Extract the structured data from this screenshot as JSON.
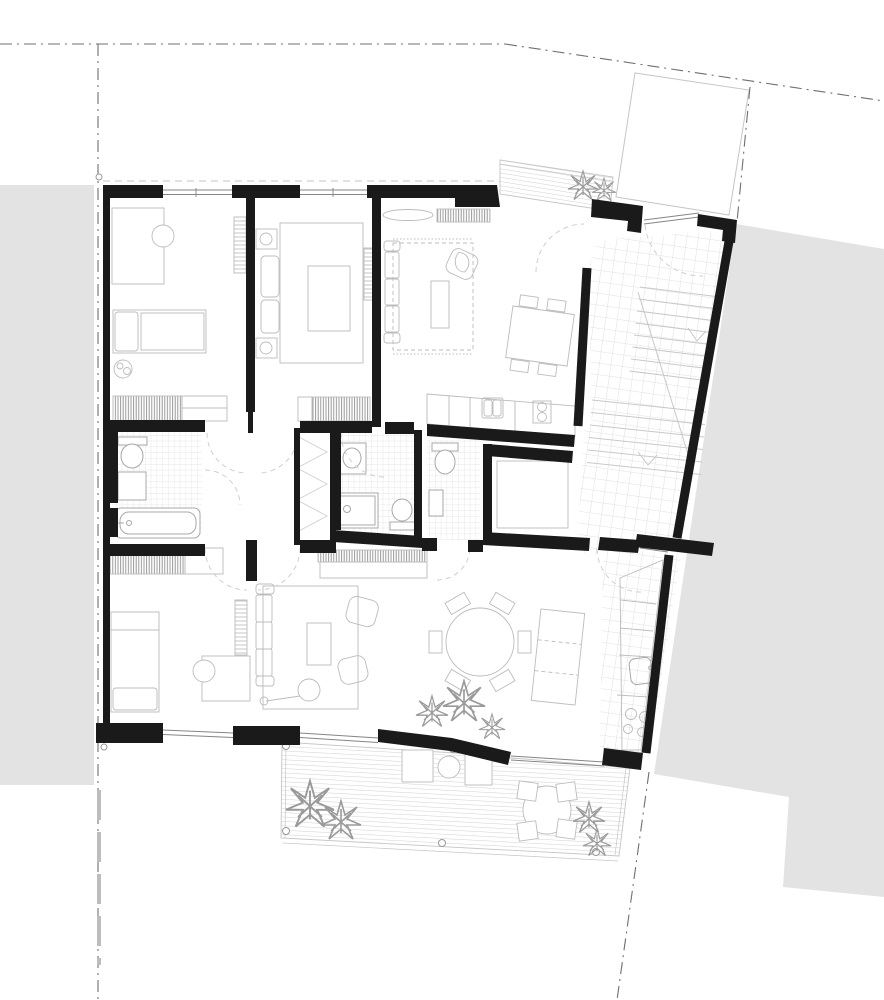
{
  "drawing": {
    "kind_label": "",
    "colors": {
      "background": "#ffffff",
      "wall": "#1a1a1a",
      "neighbor_block": "#e3e3e3",
      "furniture_line": "#bcbcbc",
      "fixture_line": "#a8a8a8",
      "tile_line": "#d8d8de",
      "tile_line_small": "#dfdfe3",
      "deck_line": "#c6c6c6",
      "boundary_line": "#6f6f6f",
      "boundary_line_light": "#bdbdbd",
      "neighbor_outline": "#c5c5c5",
      "door_arc": "#cfcfcf",
      "window_line": "#858585",
      "hatch_line": "#8f8f8f",
      "rung_line": "#b5b5b5",
      "overhang_dash": "#c4c4c4",
      "stair_line": "#c9c9c9",
      "plant_line": "#9a9a9a",
      "post_line": "#999999"
    }
  }
}
